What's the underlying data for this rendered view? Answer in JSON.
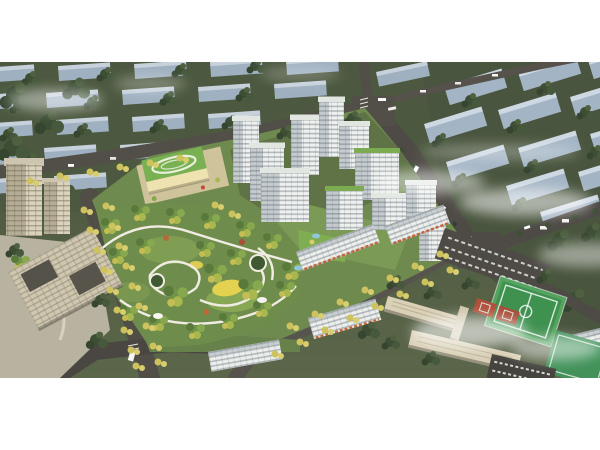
{
  "scene": {
    "type": "aerial-architectural-rendering",
    "description": "Bird's-eye daytime architectural rendering of a residential master plan: white high-rise apartment towers around a landscaped central park with winding white paths, a kindergarten with a green roof and rooftop oval track, beige office buildings on the left, mid-rise shop-front slabs along a south street, a school campus with a green sports field, running track and red basketball courts at lower right, tree-lined boulevards with yellow street trees, and rows of distant pale apartment blocks fading into white mist at the top. No text appears in the image.",
    "time_of_day": "day",
    "no_visible_text": true,
    "letterbox": {
      "top_band_px": 62,
      "bottom_band_px": 72,
      "band_color": "#ffffff"
    }
  },
  "elements": {
    "residential_towers": {
      "count": 11,
      "style": "white high-rise with horizontal window bands"
    },
    "retail_slabs": {
      "count": 5,
      "feature": "ground-floor shops with orange awnings"
    },
    "kindergarten": {
      "roof_color": "#79b052",
      "feature": "rooftop oval running loop"
    },
    "central_park": {
      "features": [
        "winding white paths",
        "bright yellow lawn",
        "two circular plazas",
        "mixed green, olive and yellow trees",
        "white shade canopies"
      ]
    },
    "office_buildings": {
      "count": 3,
      "color": "beige",
      "feature": "low block with dark interior courtyards"
    },
    "sports_campus": {
      "features": [
        "green football field with track lines",
        "red basketball courts",
        "dark parking lots with cars",
        "beige-roofed school slabs"
      ]
    },
    "roads": [
      "west boulevard with yellow street trees and white bus",
      "north road past kindergarten",
      "east boundary avenue with median trees",
      "south shopping street",
      "northeast arterial with buses"
    ],
    "distant_city": {
      "style": "rows of pale blue-grey slab blocks among dark green trees",
      "left_rows": 5,
      "right_rows": 4
    },
    "fog_patches": 9
  },
  "palette": {
    "ground_olive": "#4c583f",
    "park_green": "#6e8c4b",
    "tree_dark": "#3d4e35",
    "tree_yellow": "#cdc25d",
    "tower_white": "#eff1ee",
    "distant_slab": "#a3b4c4",
    "road_asphalt": "#4e4a45",
    "school_roof": "#79b052",
    "office_beige": "#cfc7b0",
    "field_green": "#3f9150",
    "court_red": "#b0503a",
    "lawn_yellow": "#e3d24f",
    "mist_white": "#ffffff"
  }
}
